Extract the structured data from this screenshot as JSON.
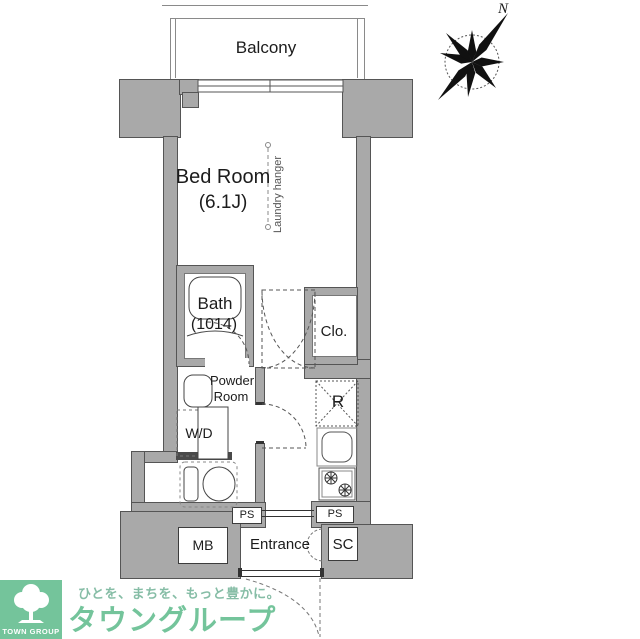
{
  "colors": {
    "wall": "#a9a9a9",
    "wall_line": "#555555",
    "ink": "#1c1c1c",
    "brand_green": "#74c49b",
    "tagline_green": "#86bda6"
  },
  "floorplan": {
    "balcony_label": "Balcony",
    "bedroom_label": "Bed Room",
    "bedroom_size": "(6.1J)",
    "laundry_label": "Laundry hanger",
    "bath_label": "Bath",
    "bath_size": "(1014)",
    "closet_label": "Clo.",
    "powder_line1": "Powder",
    "powder_line2": "Room",
    "washer_label": "W/D",
    "fridge_label": "R",
    "ps_left_label": "PS",
    "ps_right_label": "PS",
    "mailbox_label": "MB",
    "entrance_label": "Entrance",
    "shoe_closet_label": "SC",
    "compass_north_label": "N"
  },
  "branding": {
    "tagline": "ひとを、まちを、もっと豊かに。",
    "company_name": "タウングループ",
    "logo_text": "TOWN GROUP"
  }
}
